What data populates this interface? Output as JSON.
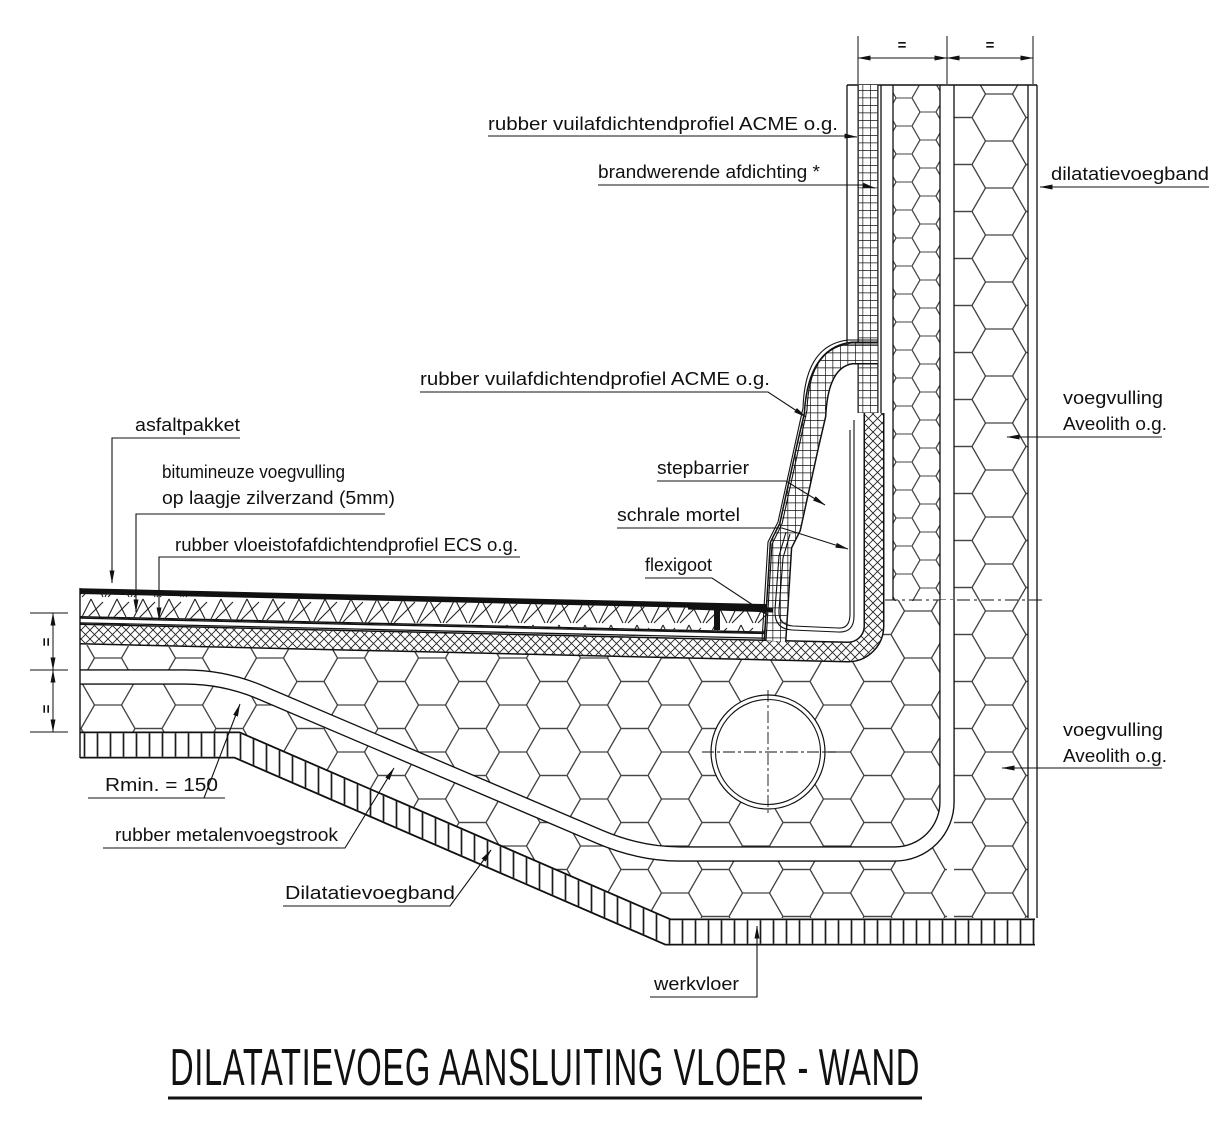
{
  "title": "DILATATIEVOEG AANSLUITING VLOER - WAND",
  "dimensions": {
    "top_left_eq": "=",
    "top_right_eq": "=",
    "left_upper_eq": "=",
    "left_lower_eq": "=",
    "radius_note": "Rmin. = 150"
  },
  "labels": {
    "top_profile": "rubber vuilafdichtendprofiel ACME o.g.",
    "fire_seal": "brandwerende afdichting *",
    "dilatation_band_right": "dilatatievoegband",
    "joint_fill_upper_line1": "voegvulling",
    "joint_fill_upper_line2": "Aveolith o.g.",
    "joint_fill_lower_line1": "voegvulling",
    "joint_fill_lower_line2": "Aveolith o.g.",
    "mid_profile": "rubber vuilafdichtendprofiel ACME o.g.",
    "stepbarrier": "stepbarrier",
    "lean_mortar": "schrale mortel",
    "flexi_gutter": "flexigoot",
    "asphalt_package": "asfaltpakket",
    "bituminous_fill_line1": "bitumineuze voegvulling",
    "bituminous_fill_line2": "op laagje zilverzand (5mm)",
    "liquid_seal_profile": "rubber vloeistofafdichtendprofiel ECS o.g.",
    "metal_joint_strip": "rubber metalenvoegstrook",
    "dilatation_band_bottom": "Dilatatievoegband",
    "work_floor": "werkvloer"
  },
  "colors": {
    "line": "#111111",
    "hatch": "#3a3a3a",
    "background": "#ffffff"
  }
}
